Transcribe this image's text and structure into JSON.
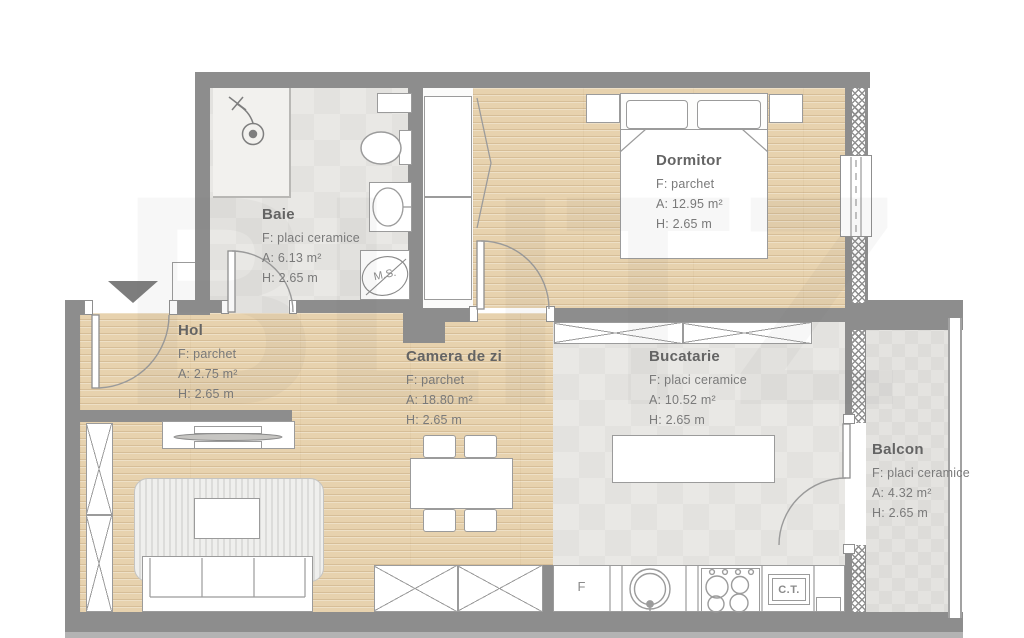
{
  "watermark": "BLITZ",
  "rooms": [
    {
      "name": "Baie",
      "floor": "F: placi ceramice",
      "area": "A: 6.13 m²",
      "height": "H: 2.65 m"
    },
    {
      "name": "Dormitor",
      "floor": "F: parchet",
      "area": "A: 12.95 m²",
      "height": "H: 2.65 m"
    },
    {
      "name": "Hol",
      "floor": "F: parchet",
      "area": "A: 2.75 m²",
      "height": "H: 2.65 m"
    },
    {
      "name": "Camera de zi",
      "floor": "F: parchet",
      "area": "A: 18.80 m²",
      "height": "H: 2.65 m"
    },
    {
      "name": "Bucatarie",
      "floor": "F: placi ceramice",
      "area": "A: 10.52 m²",
      "height": "H: 2.65 m"
    },
    {
      "name": "Balcon",
      "floor": "F: placi ceramice",
      "area": "A: 4.32 m²",
      "height": "H: 2.65 m"
    }
  ],
  "appliances": {
    "fridge": "F",
    "washing_machine": "M.S.",
    "boiler": "C.T."
  },
  "colors": {
    "wall": "#8d8d8d",
    "parquet": "#e7d2ae",
    "ceramic_tile": "#e8e7e4",
    "furniture_outline": "#9b9b9b"
  }
}
